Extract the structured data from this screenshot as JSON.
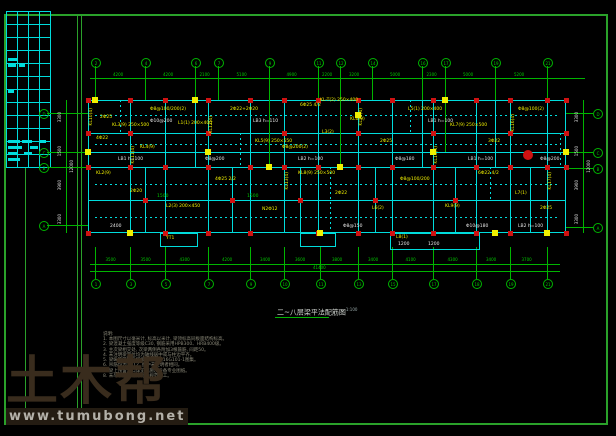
{
  "watermark": {
    "brand": "土木帮",
    "url": "www.tumubong.net"
  },
  "title": {
    "text": "二~八层梁平法配筋图",
    "scale": "1:100"
  },
  "notes": {
    "heading": "说明:",
    "lines": [
      "1. 本图尺寸以毫米计, 标高以米计, 梁顶标高同板面结构标高。",
      "2. 梁混凝土强度等级C30, 钢筋采用HPB300、HRB400级。",
      "3. 主次梁相交处, 次梁两侧各附加3根箍筋, 间距50。",
      "4. 未注明梁定位均为轴线居中或与柱边平齐。",
      "5. 梁纵筋锚固及搭接构造详见16G101-1图集。",
      "6. 吊筋均为2Φ12, 图中未注明者相同。",
      "7. 梁上预留洞口详见建施及设备专业图纸。",
      "8. 未尽事宜按现行有关规范施工。"
    ]
  },
  "colors": {
    "frame": "#2aa12a",
    "grid": "#00b400",
    "wall": "#00dcdc",
    "label": "#f0f000",
    "column": "#cf1212",
    "dim": "#00c800",
    "white": "#e6e6e6"
  },
  "axes": {
    "top": {
      "cy": 62,
      "bubbles": [
        {
          "x": 95,
          "n": "2"
        },
        {
          "x": 145,
          "n": "4"
        },
        {
          "x": 195,
          "n": "6"
        },
        {
          "x": 218,
          "n": "7"
        },
        {
          "x": 269,
          "n": "9"
        },
        {
          "x": 318,
          "n": "11"
        },
        {
          "x": 340,
          "n": "12"
        },
        {
          "x": 372,
          "n": "14"
        },
        {
          "x": 422,
          "n": "16"
        },
        {
          "x": 445,
          "n": "17"
        },
        {
          "x": 495,
          "n": "19"
        },
        {
          "x": 547,
          "n": "21"
        }
      ],
      "dims": [
        "4200",
        "4200",
        "2100",
        "5100",
        "4900",
        "2200",
        "3200",
        "5000",
        "2300",
        "5000",
        "5200"
      ]
    },
    "bottom": {
      "cy": 283,
      "bubbles": [
        {
          "x": 95,
          "n": "1"
        },
        {
          "x": 130,
          "n": "3"
        },
        {
          "x": 165,
          "n": "5"
        },
        {
          "x": 208,
          "n": "7"
        },
        {
          "x": 250,
          "n": "9"
        },
        {
          "x": 284,
          "n": "10"
        },
        {
          "x": 320,
          "n": "11"
        },
        {
          "x": 358,
          "n": "13"
        },
        {
          "x": 392,
          "n": "15"
        },
        {
          "x": 433,
          "n": "17"
        },
        {
          "x": 476,
          "n": "18"
        },
        {
          "x": 510,
          "n": "19"
        },
        {
          "x": 547,
          "n": "21"
        }
      ],
      "dims": [
        "3500",
        "3500",
        "4300",
        "4200",
        "3400",
        "3600",
        "3800",
        "3400",
        "4100",
        "4300",
        "3400",
        "3700"
      ],
      "total": "41400"
    },
    "left": {
      "cx": 43,
      "bubbles": [
        {
          "y": 113,
          "n": "D"
        },
        {
          "y": 152,
          "n": "C"
        },
        {
          "y": 167,
          "n": "B"
        },
        {
          "y": 225,
          "n": "A"
        }
      ],
      "dims": [
        {
          "t": "3300",
          "x": 58,
          "y": 112
        },
        {
          "t": "1500",
          "x": 58,
          "y": 146
        },
        {
          "t": "3900",
          "x": 58,
          "y": 180
        },
        {
          "t": "3300",
          "x": 58,
          "y": 214
        },
        {
          "t": "12000",
          "x": 70,
          "y": 160
        }
      ]
    },
    "right": {
      "cx": 597,
      "bubbles": [
        {
          "y": 113,
          "n": "D"
        },
        {
          "y": 152,
          "n": "C"
        },
        {
          "y": 168,
          "n": "B"
        },
        {
          "y": 227,
          "n": "A"
        }
      ],
      "dims": [
        {
          "t": "3300",
          "x": 575,
          "y": 112
        },
        {
          "t": "1500",
          "x": 575,
          "y": 146
        },
        {
          "t": "3900",
          "x": 575,
          "y": 180
        },
        {
          "t": "3300",
          "x": 575,
          "y": 214
        },
        {
          "t": "12000",
          "x": 587,
          "y": 160
        }
      ]
    }
  },
  "plan": {
    "outer": {
      "x": 88,
      "y": 100,
      "w": 478,
      "h": 133
    },
    "walls_v": [
      {
        "x": 130,
        "y1": 100,
        "y2": 233
      },
      {
        "x": 165,
        "y1": 100,
        "y2": 233
      },
      {
        "x": 195,
        "y1": 100,
        "y2": 167
      },
      {
        "x": 208,
        "y1": 100,
        "y2": 233
      },
      {
        "x": 250,
        "y1": 100,
        "y2": 233
      },
      {
        "x": 269,
        "y1": 100,
        "y2": 167
      },
      {
        "x": 284,
        "y1": 100,
        "y2": 233
      },
      {
        "x": 318,
        "y1": 100,
        "y2": 233
      },
      {
        "x": 340,
        "y1": 100,
        "y2": 167
      },
      {
        "x": 358,
        "y1": 100,
        "y2": 233
      },
      {
        "x": 392,
        "y1": 100,
        "y2": 233
      },
      {
        "x": 422,
        "y1": 100,
        "y2": 167
      },
      {
        "x": 433,
        "y1": 100,
        "y2": 233
      },
      {
        "x": 476,
        "y1": 100,
        "y2": 233
      },
      {
        "x": 495,
        "y1": 100,
        "y2": 167
      },
      {
        "x": 510,
        "y1": 100,
        "y2": 233
      },
      {
        "x": 547,
        "y1": 100,
        "y2": 233
      },
      {
        "x": 145,
        "y1": 167,
        "y2": 233
      },
      {
        "x": 232,
        "y1": 167,
        "y2": 233
      },
      {
        "x": 300,
        "y1": 167,
        "y2": 233
      },
      {
        "x": 375,
        "y1": 167,
        "y2": 233
      },
      {
        "x": 455,
        "y1": 167,
        "y2": 233
      },
      {
        "x": 530,
        "y1": 167,
        "y2": 233
      }
    ],
    "walls_h": [
      {
        "y": 133,
        "x1": 88,
        "x2": 566
      },
      {
        "y": 152,
        "x1": 88,
        "x2": 566
      },
      {
        "y": 167,
        "x1": 88,
        "x2": 566
      },
      {
        "y": 200,
        "x1": 88,
        "x2": 566
      }
    ],
    "dashed_h": [
      {
        "y": 115,
        "x1": 95,
        "x2": 560
      },
      {
        "y": 144,
        "x1": 95,
        "x2": 560
      },
      {
        "y": 184,
        "x1": 95,
        "x2": 560
      },
      {
        "y": 217,
        "x1": 95,
        "x2": 560
      }
    ],
    "dashed_v": [
      {
        "x": 120,
        "y1": 100,
        "y2": 133
      },
      {
        "x": 240,
        "y1": 133,
        "y2": 167
      },
      {
        "x": 330,
        "y1": 167,
        "y2": 233
      },
      {
        "x": 410,
        "y1": 100,
        "y2": 133
      },
      {
        "x": 490,
        "y1": 167,
        "y2": 200
      },
      {
        "x": 560,
        "y1": 133,
        "y2": 167
      }
    ],
    "grid_in_v": [
      {
        "x": 269,
        "y1": 66,
        "y2": 165
      },
      {
        "x": 340,
        "y1": 66,
        "y2": 165
      },
      {
        "x": 445,
        "y1": 66,
        "y2": 152
      }
    ],
    "columns": [
      [
        88,
        100
      ],
      [
        130,
        100
      ],
      [
        165,
        100
      ],
      [
        208,
        100
      ],
      [
        250,
        100
      ],
      [
        284,
        100
      ],
      [
        318,
        100
      ],
      [
        358,
        100
      ],
      [
        392,
        100
      ],
      [
        433,
        100
      ],
      [
        476,
        100
      ],
      [
        510,
        100
      ],
      [
        547,
        100
      ],
      [
        566,
        100
      ],
      [
        88,
        133
      ],
      [
        130,
        133
      ],
      [
        208,
        133
      ],
      [
        284,
        133
      ],
      [
        358,
        133
      ],
      [
        433,
        133
      ],
      [
        510,
        133
      ],
      [
        566,
        133
      ],
      [
        88,
        167
      ],
      [
        130,
        167
      ],
      [
        165,
        167
      ],
      [
        208,
        167
      ],
      [
        250,
        167
      ],
      [
        284,
        167
      ],
      [
        318,
        167
      ],
      [
        358,
        167
      ],
      [
        392,
        167
      ],
      [
        433,
        167
      ],
      [
        476,
        167
      ],
      [
        510,
        167
      ],
      [
        547,
        167
      ],
      [
        566,
        167
      ],
      [
        88,
        233
      ],
      [
        130,
        233
      ],
      [
        165,
        233
      ],
      [
        208,
        233
      ],
      [
        250,
        233
      ],
      [
        318,
        233
      ],
      [
        358,
        233
      ],
      [
        392,
        233
      ],
      [
        433,
        233
      ],
      [
        476,
        233
      ],
      [
        510,
        233
      ],
      [
        547,
        233
      ],
      [
        566,
        233
      ],
      [
        145,
        200
      ],
      [
        232,
        200
      ],
      [
        300,
        200
      ],
      [
        375,
        200
      ],
      [
        455,
        200
      ]
    ],
    "ysquares": [
      [
        95,
        100
      ],
      [
        195,
        100
      ],
      [
        269,
        167
      ],
      [
        340,
        167
      ],
      [
        445,
        100
      ],
      [
        88,
        152
      ],
      [
        566,
        152
      ],
      [
        130,
        233
      ],
      [
        320,
        233
      ],
      [
        495,
        233
      ],
      [
        208,
        152
      ],
      [
        433,
        152
      ],
      [
        547,
        233
      ],
      [
        358,
        115
      ]
    ],
    "red_circle": {
      "x": 527,
      "y": 154
    },
    "labels": [
      {
        "t": "2Φ25",
        "x": 100,
        "y": 116,
        "c": "yel"
      },
      {
        "t": "KL3(9) 250×500",
        "x": 112,
        "y": 124,
        "c": "yel"
      },
      {
        "t": "Φ8@100/200(2)",
        "x": 150,
        "y": 108,
        "c": "yel"
      },
      {
        "t": "4Φ22",
        "x": 96,
        "y": 137,
        "c": "yel"
      },
      {
        "t": "KL4(9)",
        "x": 140,
        "y": 146,
        "c": "yel"
      },
      {
        "t": "L1(1) 200×400",
        "x": 178,
        "y": 122,
        "c": "yel"
      },
      {
        "t": "2Φ22+2Φ20",
        "x": 230,
        "y": 108,
        "c": "yel"
      },
      {
        "t": "KL5(9) 250×550",
        "x": 255,
        "y": 140,
        "c": "yel"
      },
      {
        "t": "6Φ25 4/2",
        "x": 300,
        "y": 104,
        "c": "yel"
      },
      {
        "t": "KL-T(2) 250×400",
        "x": 320,
        "y": 99,
        "c": "yel"
      },
      {
        "t": "L3(2)",
        "x": 322,
        "y": 131,
        "c": "yel"
      },
      {
        "t": "Φ8@200(2)",
        "x": 282,
        "y": 146,
        "c": "yel"
      },
      {
        "t": "KL6(9)",
        "x": 350,
        "y": 118,
        "c": "yel"
      },
      {
        "t": "2Φ25",
        "x": 380,
        "y": 140,
        "c": "yel"
      },
      {
        "t": "L5(1) 200×400",
        "x": 408,
        "y": 108,
        "c": "yel"
      },
      {
        "t": "KL7(9) 250×500",
        "x": 450,
        "y": 124,
        "c": "yel"
      },
      {
        "t": "3Φ22",
        "x": 488,
        "y": 140,
        "c": "yel"
      },
      {
        "t": "Φ8@100(2)",
        "x": 518,
        "y": 108,
        "c": "yel"
      },
      {
        "t": "KL2(9)",
        "x": 96,
        "y": 172,
        "c": "yel"
      },
      {
        "t": "2Φ20",
        "x": 130,
        "y": 190,
        "c": "yel"
      },
      {
        "t": "L2(3) 200×450",
        "x": 166,
        "y": 205,
        "c": "yel"
      },
      {
        "t": "4Φ25 2/2",
        "x": 215,
        "y": 178,
        "c": "yel"
      },
      {
        "t": "N2Φ12",
        "x": 262,
        "y": 208,
        "c": "yel"
      },
      {
        "t": "KL8(9) 250×500",
        "x": 298,
        "y": 172,
        "c": "yel"
      },
      {
        "t": "2Φ22",
        "x": 335,
        "y": 192,
        "c": "yel"
      },
      {
        "t": "L6(2)",
        "x": 372,
        "y": 207,
        "c": "yel"
      },
      {
        "t": "Φ8@100/200",
        "x": 400,
        "y": 178,
        "c": "yel"
      },
      {
        "t": "KL9(9)",
        "x": 445,
        "y": 205,
        "c": "yel"
      },
      {
        "t": "6Φ22 4/2",
        "x": 478,
        "y": 172,
        "c": "yel"
      },
      {
        "t": "L7(1)",
        "x": 515,
        "y": 192,
        "c": "yel"
      },
      {
        "t": "2Φ25",
        "x": 540,
        "y": 207,
        "c": "yel"
      },
      {
        "t": "YT1",
        "x": 166,
        "y": 237,
        "c": "yel"
      },
      {
        "t": "L8(1)",
        "x": 396,
        "y": 236,
        "c": "yel"
      },
      {
        "t": "KL10(4)",
        "x": 90,
        "y": 108,
        "c": "yel",
        "r": 1
      },
      {
        "t": "KL11(4)",
        "x": 132,
        "y": 146,
        "c": "yel",
        "r": 1
      },
      {
        "t": "KL12(4)",
        "x": 210,
        "y": 116,
        "c": "yel",
        "r": 1
      },
      {
        "t": "KL13(4)",
        "x": 286,
        "y": 172,
        "c": "yel",
        "r": 1
      },
      {
        "t": "KL14(4)",
        "x": 360,
        "y": 108,
        "c": "yel",
        "r": 1
      },
      {
        "t": "KL15(4)",
        "x": 435,
        "y": 146,
        "c": "yel",
        "r": 1
      },
      {
        "t": "KL16(4)",
        "x": 512,
        "y": 114,
        "c": "yel",
        "r": 1
      },
      {
        "t": "KL17(4)",
        "x": 549,
        "y": 172,
        "c": "yel",
        "r": 1
      },
      {
        "t": "LB1 h=100",
        "x": 118,
        "y": 158,
        "c": "wht"
      },
      {
        "t": "Φ8@200",
        "x": 205,
        "y": 158,
        "c": "wht"
      },
      {
        "t": "LB2 h=100",
        "x": 298,
        "y": 158,
        "c": "wht"
      },
      {
        "t": "Φ8@180",
        "x": 395,
        "y": 158,
        "c": "wht"
      },
      {
        "t": "LB1 h=100",
        "x": 468,
        "y": 158,
        "c": "wht"
      },
      {
        "t": "Φ8@200",
        "x": 540,
        "y": 158,
        "c": "wht"
      },
      {
        "t": "Φ10@200",
        "x": 150,
        "y": 120,
        "c": "wht"
      },
      {
        "t": "LB3 h=110",
        "x": 253,
        "y": 120,
        "c": "wht"
      },
      {
        "t": "LB1 h=100",
        "x": 428,
        "y": 120,
        "c": "wht"
      },
      {
        "t": "2400",
        "x": 110,
        "y": 225,
        "c": "wht"
      },
      {
        "t": "Φ8@150",
        "x": 343,
        "y": 225,
        "c": "wht"
      },
      {
        "t": "Φ10@180",
        "x": 466,
        "y": 225,
        "c": "wht"
      },
      {
        "t": "LB2 h=100",
        "x": 518,
        "y": 225,
        "c": "wht"
      },
      {
        "t": "1500",
        "x": 157,
        "y": 195,
        "c": "grn"
      },
      {
        "t": "1500",
        "x": 247,
        "y": 195,
        "c": "grn"
      },
      {
        "t": "1200",
        "x": 398,
        "y": 243,
        "c": "wht"
      },
      {
        "t": "1200",
        "x": 428,
        "y": 243,
        "c": "wht"
      }
    ],
    "protrusions": [
      {
        "x": 160,
        "y": 233,
        "w": 38,
        "h": 14
      },
      {
        "x": 300,
        "y": 233,
        "w": 36,
        "h": 14
      },
      {
        "x": 390,
        "y": 233,
        "w": 90,
        "h": 17
      }
    ]
  }
}
